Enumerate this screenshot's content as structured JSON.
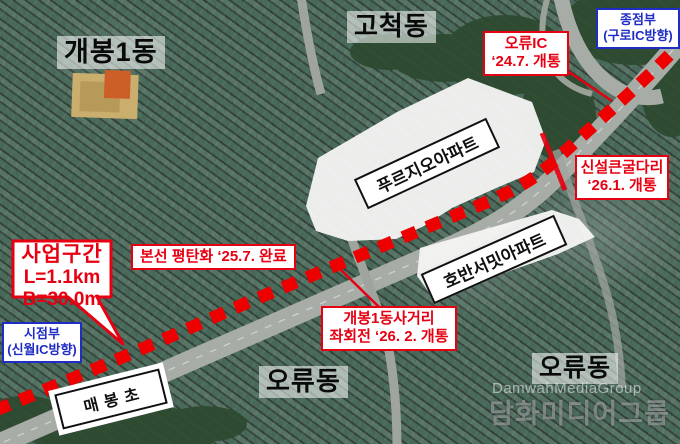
{
  "colors": {
    "accent_red": "#e60012",
    "accent_blue": "#1f2dc4",
    "dash_red": "#ee0000",
    "plate_black": "#101010"
  },
  "districts": {
    "gaebong1": "개봉1동",
    "gocheok": "고척동",
    "oryu_a": "오류동",
    "oryu_b": "오류동"
  },
  "markers": {
    "end_point": {
      "line1": "종점부",
      "line2": "(구로IC방향)"
    },
    "start_point": {
      "line1": "시점부",
      "line2": "(신월IC방향)"
    },
    "oryu_ic": {
      "line1": "오류IC",
      "line2": "‘24.7. 개통"
    },
    "bridge": {
      "line1": "신설큰굴다리",
      "line2": "‘26.1. 개통"
    },
    "mainline": {
      "line1": "본선 평탄화 ‘25.7. 완료"
    },
    "intersection": {
      "line1": "개봉1동사거리",
      "line2": "좌회전 ‘26. 2. 개통"
    },
    "project": {
      "line1": "사업구간",
      "line2": "L=1.1km",
      "line3": "B=30.0m"
    }
  },
  "places": {
    "prugio_apt": "푸르지오아파트",
    "hoban_apt": "호반서밋아파트",
    "maebong_school": "매봉초"
  },
  "watermark": {
    "en": "DamwahMediaGroup",
    "ko": "담화미디어그룹"
  }
}
